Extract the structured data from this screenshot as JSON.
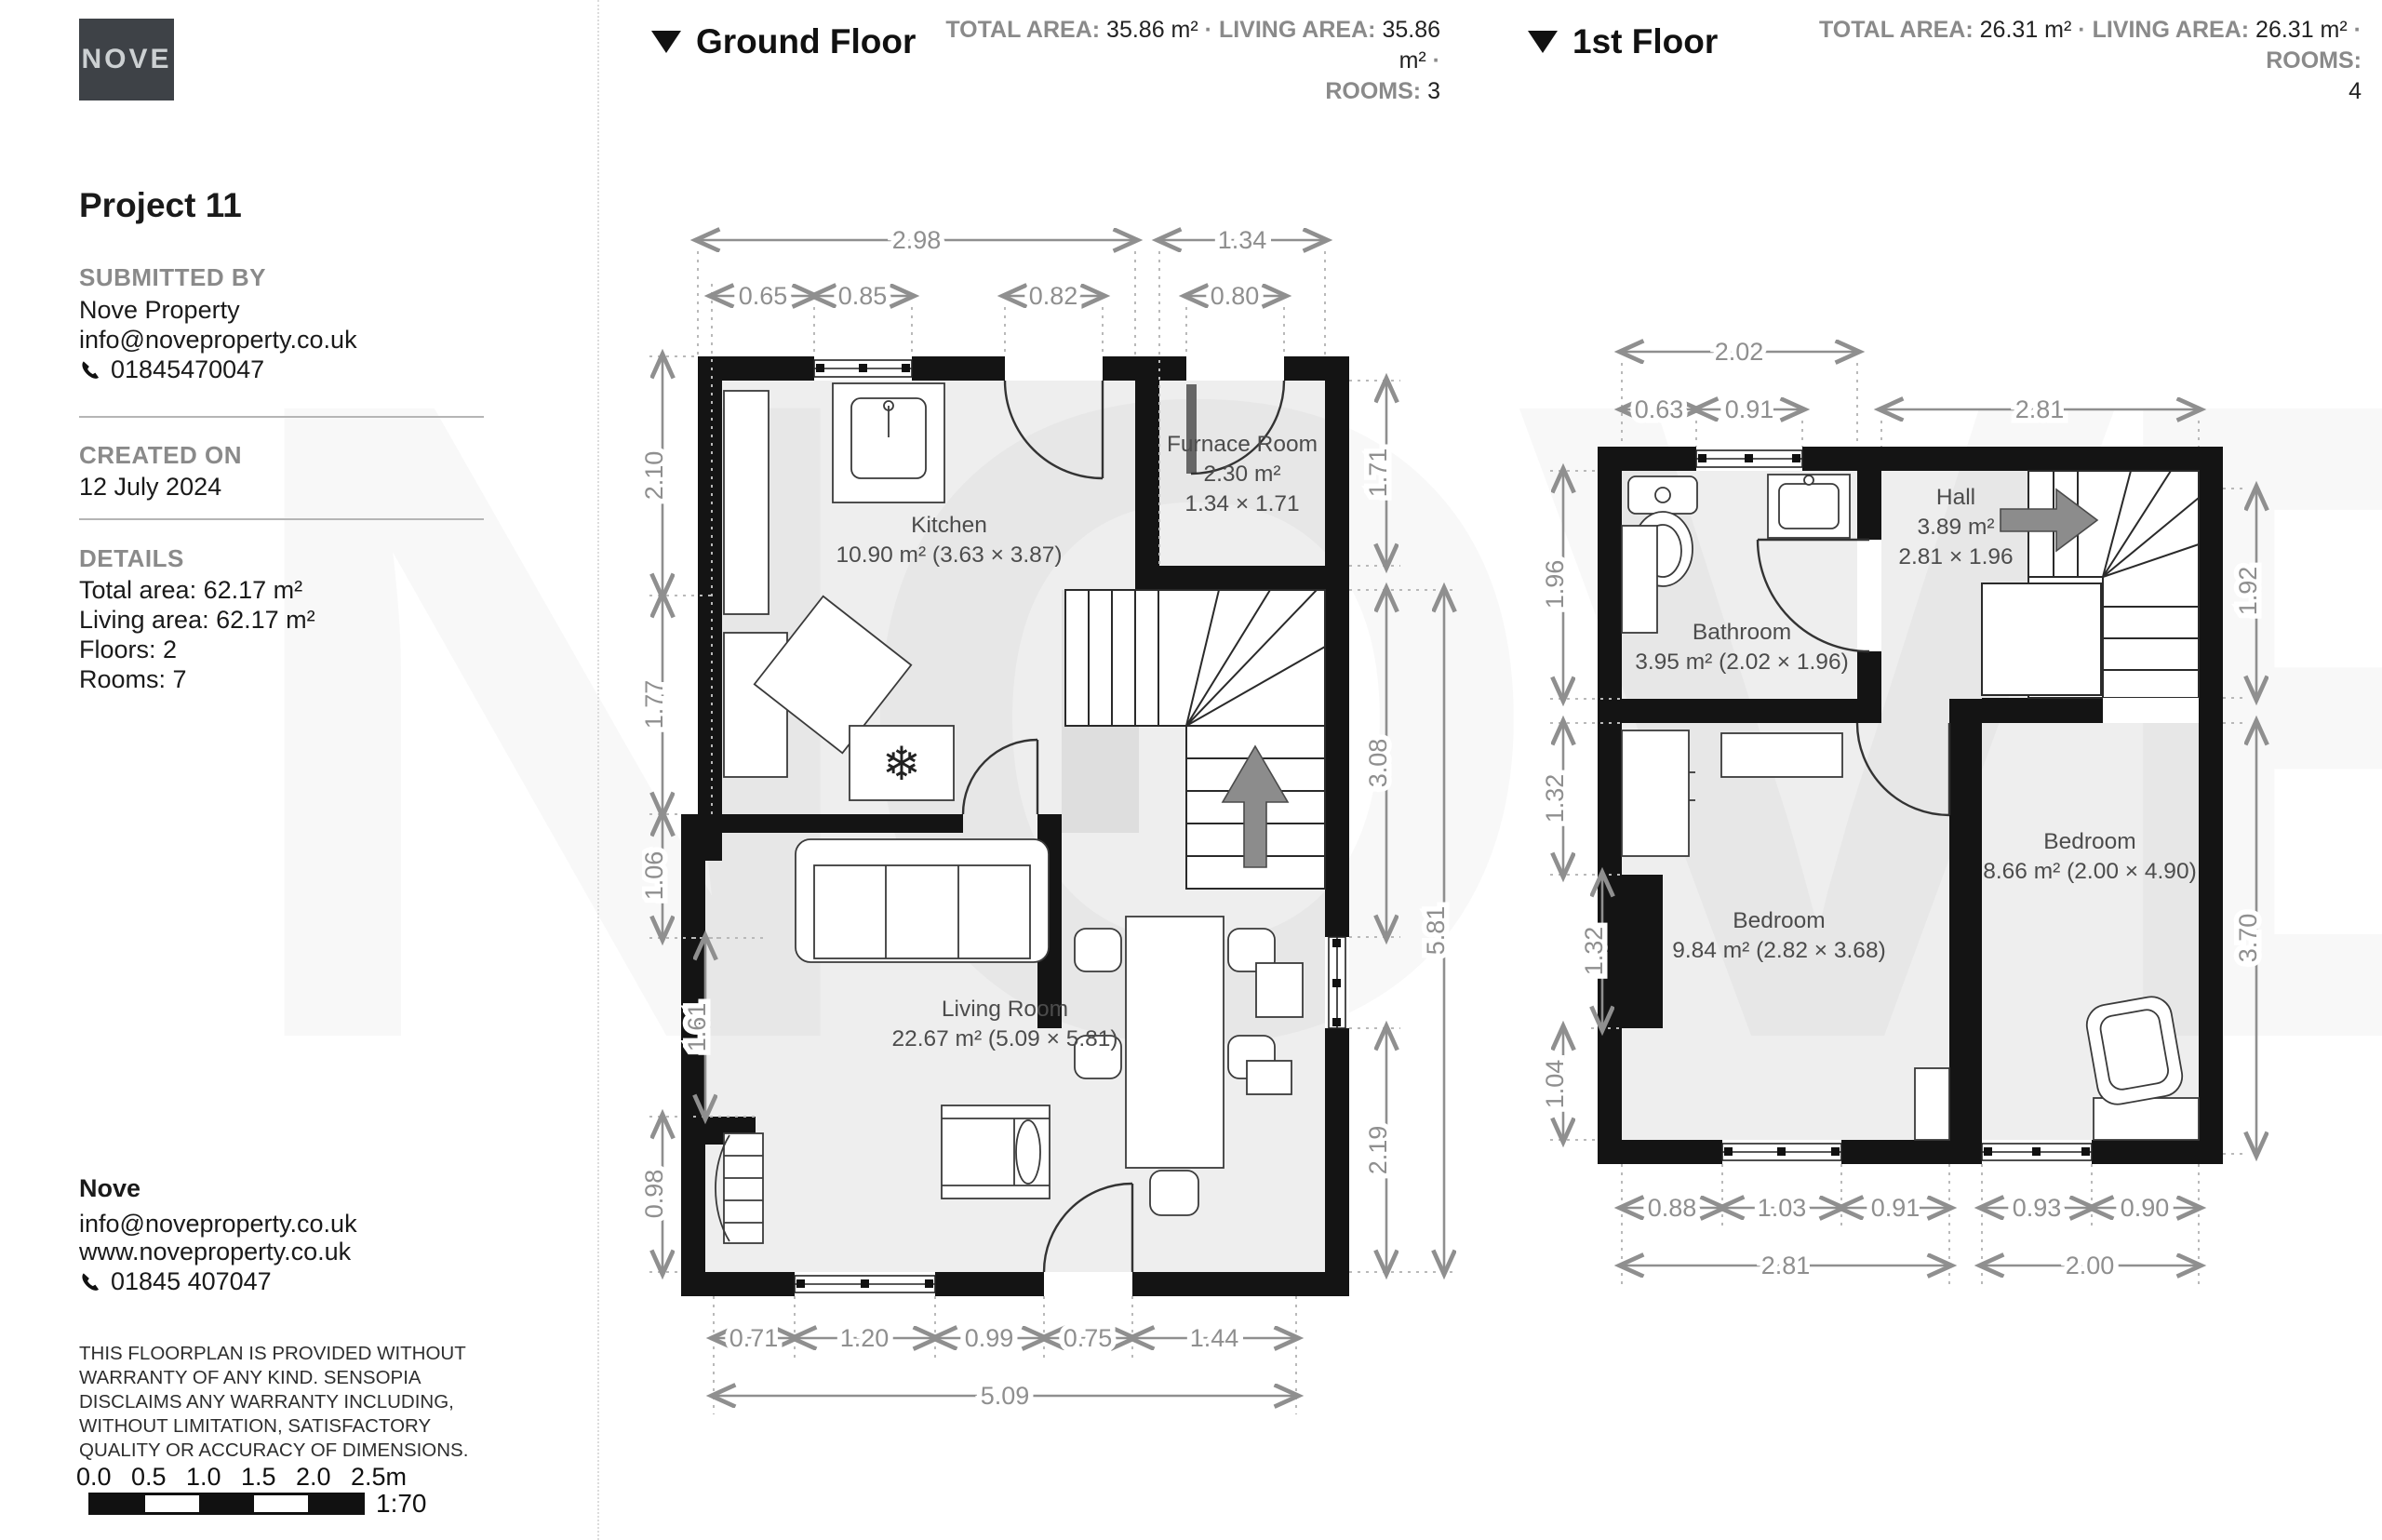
{
  "branding": {
    "logo_text": "NOVE",
    "watermark": "NOVE"
  },
  "sidebar": {
    "project_title": "Project 11",
    "submitted_by_heading": "SUBMITTED BY",
    "submitted_by_name": "Nove Property",
    "submitted_by_email": "info@noveproperty.co.uk",
    "submitted_by_phone": "01845470047",
    "created_on_heading": "CREATED ON",
    "created_on_date": "12 July 2024",
    "details_heading": "DETAILS",
    "details_lines": [
      "Total area: 62.17 m²",
      "Living area: 62.17 m²",
      "Floors: 2",
      "Rooms: 7"
    ],
    "footer_company": "Nove",
    "footer_email": "info@noveproperty.co.uk",
    "footer_website": "www.noveproperty.co.uk",
    "footer_phone": "01845 407047",
    "disclaimer": "THIS FLOORPLAN IS PROVIDED WITHOUT WARRANTY OF ANY KIND. SENSOPIA DISCLAIMS ANY WARRANTY INCLUDING, WITHOUT LIMITATION, SATISFACTORY QUALITY OR ACCURACY OF DIMENSIONS.",
    "scale_ticks": [
      "0.0",
      "0.5",
      "1.0",
      "1.5",
      "2.0",
      "2.5m"
    ],
    "scale_ratio": "1:70"
  },
  "ground_floor": {
    "title": "Ground Floor",
    "stats": {
      "total_label": "TOTAL AREA:",
      "total": "35.86 m²",
      "living_label": "LIVING AREA:",
      "living": "35.86 m²",
      "rooms_label": "ROOMS:",
      "rooms": "3",
      "sep": "·"
    },
    "rooms": {
      "kitchen": {
        "name": "Kitchen",
        "detail": "10.90 m² (3.63 × 3.87)"
      },
      "furnace": {
        "name": "Furnace Room",
        "area": "2.30 m²",
        "size": "1.34 × 1.71"
      },
      "living": {
        "name": "Living Room",
        "detail": "22.67 m² (5.09 × 5.81)"
      }
    },
    "dims": {
      "top_298": "2.98",
      "top_134": "1.34",
      "top_065": "0.65",
      "top_085": "0.85",
      "top_082": "0.82",
      "top_080": "0.80",
      "left_210": "2.10",
      "left_177": "1.77",
      "left_106": "1.06",
      "left_161": "1.61",
      "left_098": "0.98",
      "right_171": "1.71",
      "right_308": "3.08",
      "right_581": "5.81",
      "right_219": "2.19",
      "bot_071": "0.71",
      "bot_120": "1.20",
      "bot_099": "0.99",
      "bot_075": "0.75",
      "bot_144": "1.44",
      "bot_509": "5.09"
    }
  },
  "first_floor": {
    "title": "1st Floor",
    "stats": {
      "total_label": "TOTAL AREA:",
      "total": "26.31 m²",
      "living_label": "LIVING AREA:",
      "living": "26.31 m²",
      "rooms_label": "ROOMS:",
      "rooms": "4",
      "sep": "·"
    },
    "rooms": {
      "hall": {
        "name": "Hall",
        "area": "3.89 m²",
        "size": "2.81 × 1.96"
      },
      "bathroom": {
        "name": "Bathroom",
        "detail": "3.95 m² (2.02 × 1.96)"
      },
      "bedroom1": {
        "name": "Bedroom",
        "detail": "9.84 m² (2.82 × 3.68)"
      },
      "bedroom2": {
        "name": "Bedroom",
        "detail": "8.66 m² (2.00 × 4.90)"
      }
    },
    "dims": {
      "top_202": "2.02",
      "top_063": "0.63",
      "top_091": "0.91",
      "top_281": "2.81",
      "left_196": "1.96",
      "left_132a": "1.32",
      "left_132b": "1.32",
      "left_104": "1.04",
      "right_192": "1.92",
      "right_370": "3.70",
      "bot_088": "0.88",
      "bot_103": "1.03",
      "bot_091": "0.91",
      "bot_093": "0.93",
      "bot_090": "0.90",
      "bot_281": "2.81",
      "bot_200": "2.00"
    }
  }
}
